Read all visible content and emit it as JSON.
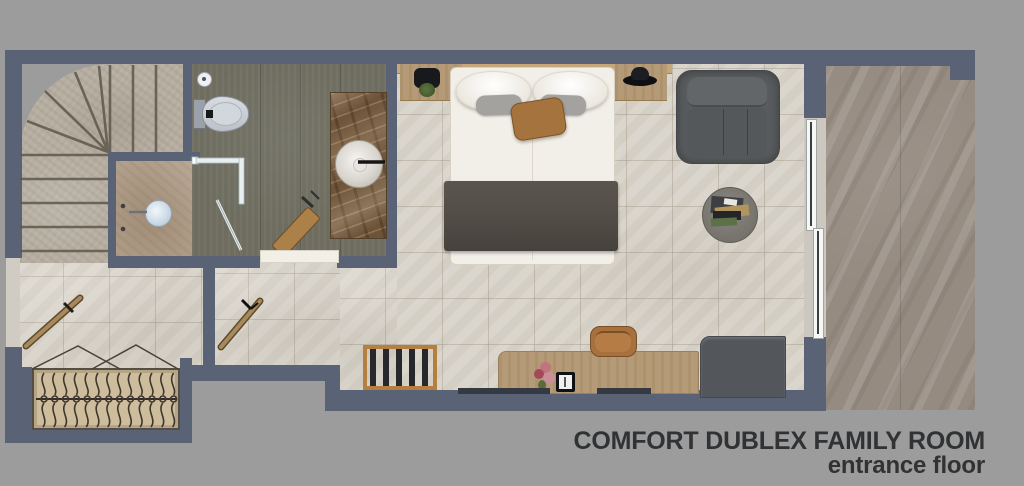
{
  "title": {
    "line1": "COMFORT DUBLEX FAMILY ROOM",
    "line2": "entrance floor"
  },
  "colors": {
    "background": "#9c9c9c",
    "wall": "#5a6375",
    "bedroom_tile": "#d9d4ca",
    "bathroom_floor": "#6e6d60",
    "stair_stone": "#b6aea1",
    "balcony_stone": "#968b81",
    "marble_vanity": "#6d5338",
    "wood": "#b49a76",
    "armchair_gray": "#595c5e",
    "text": "#303234"
  },
  "plan": {
    "rooms": [
      {
        "id": "staircase",
        "label": "winder staircase"
      },
      {
        "id": "bathroom",
        "label": "bathroom"
      },
      {
        "id": "shower",
        "label": "shower enclosure"
      },
      {
        "id": "entry-hall",
        "label": "entry hall with wardrobe"
      },
      {
        "id": "vestibule",
        "label": "vestibule"
      },
      {
        "id": "bedroom",
        "label": "bedroom"
      },
      {
        "id": "balcony",
        "label": "balcony terrace"
      }
    ],
    "furniture": [
      "double-bed",
      "pillows",
      "accent-pillow",
      "bed-throw",
      "headboard-ledge",
      "nightstand-left",
      "nightstand-right",
      "table-lamp",
      "plant",
      "armchair",
      "round-side-table",
      "books-tray",
      "desk",
      "desk-chair",
      "flower-vase",
      "tablet",
      "cabinet",
      "luggage-rack",
      "wardrobe-with-hangers",
      "toilet",
      "floor-drain",
      "marble-vanity",
      "round-sink",
      "faucet",
      "shower-head",
      "glass-shower-screen",
      "wooden-stool",
      "sliding-glass-door",
      "entrance-door",
      "bathroom-door",
      "window-sills"
    ]
  }
}
